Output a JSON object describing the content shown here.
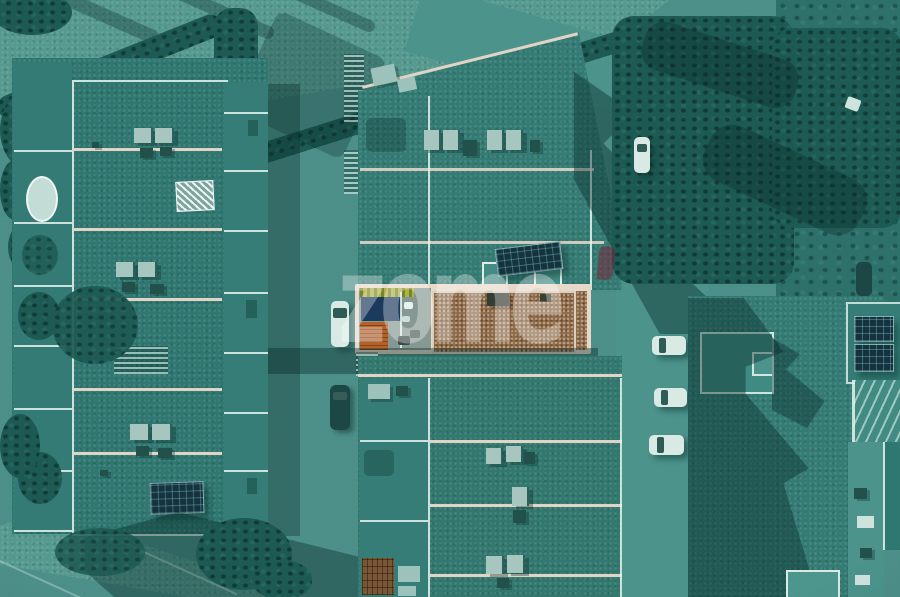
{
  "watermark": {
    "text": "zome",
    "color": "rgba(255,255,255,0.32)",
    "accent_color": "rgba(130,26,46,0.48)"
  },
  "photo": {
    "kind": "aerial-drone-photograph",
    "treatment": "teal duotone filter; listed property roof left in natural colour",
    "highlighted_property": {
      "gravel_roof_color": "#8d6a49",
      "wood_deck_color": "#b5622c",
      "plunge_pool_color": "#1b3a5e",
      "planter_color": "#b0b244",
      "parapet_color": "#e7d9c9"
    },
    "vehicles": {
      "white_cars": 5,
      "dark_cars": 2
    },
    "palette": {
      "ground": "#38827b",
      "road": "#55998f",
      "roof": "#31786f",
      "cast_shadow": "rgba(8,42,40,0.4)",
      "vegetation": "#1d5a53",
      "parapet_cool": "#e6f2ee",
      "parapet_warm": "#e0d4c6",
      "solar_panel": "#14333c",
      "car_white": "#d9eae5",
      "car_dark": "#1c4744"
    }
  }
}
